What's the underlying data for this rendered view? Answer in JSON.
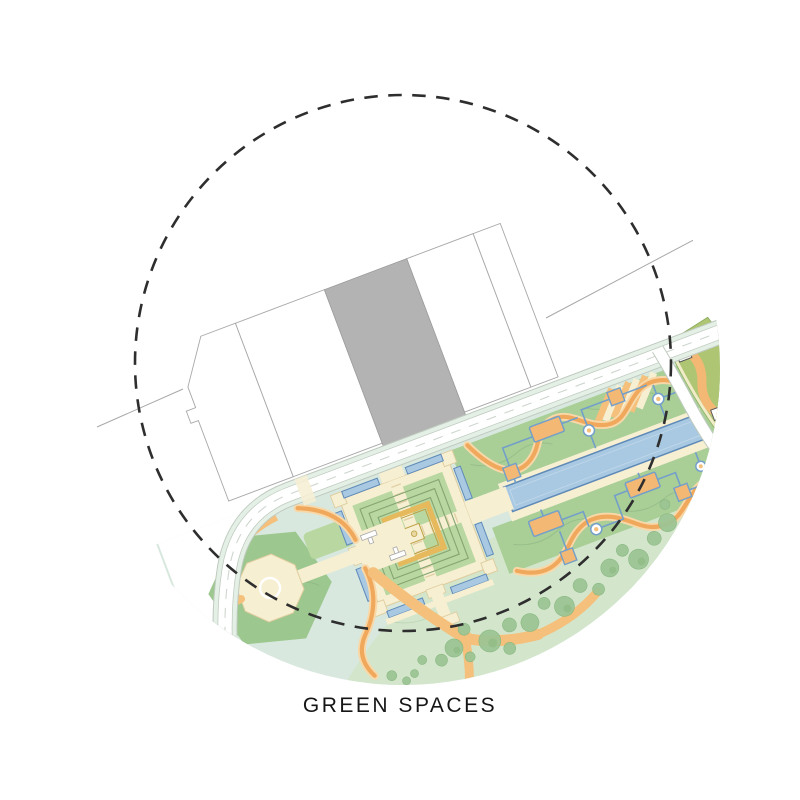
{
  "caption": {
    "label": "GREEN SPACES"
  },
  "diagram": {
    "type": "architectural-site-plan",
    "subject": "green spaces of a masterplan highlighted inside a dashed study circle",
    "features": [
      "dashed study circle",
      "building plots row",
      "highlighted gray building",
      "main road",
      "branch road",
      "charbagh square garden",
      "long reflecting pool",
      "hexagonal plaza with fountain",
      "ceremonial axis with gate piers",
      "upper garden strip with path network",
      "lower garden strip with path network",
      "meadow with tree clusters",
      "serpentine paths",
      "olive side parcel with buildings"
    ]
  },
  "colors": {
    "dash": "#2e2e2e",
    "captioncolor": "#161616",
    "outline": "#a8a8a8",
    "buildgray": "#b3b3b3",
    "roadline": "#bfcabf",
    "roadedge": "#e4f0e6",
    "mint": "#d8e8de",
    "stripgreen": "#a9cf97",
    "quadgreen": "#b9d7a0",
    "quadline": "#84a471",
    "hexgreen": "#9cc78e",
    "meadow": "#d3e6cc",
    "tree": "#9cc594",
    "treedark": "#8cb983",
    "contour": "#86ab7c",
    "cream": "#f7efd2",
    "creamline": "#ddcc9e",
    "gold": "#e5b95c",
    "golddark": "#bd9f42",
    "water": "#a9c9e2",
    "waterline": "#5f8ab8",
    "blue": "#739fc9",
    "orangepath": "#f0a95c",
    "orangehalo": "#f8d8a8",
    "orangeband": "#f4c07c",
    "platform": "#f3b873",
    "olive": "#aec573"
  }
}
